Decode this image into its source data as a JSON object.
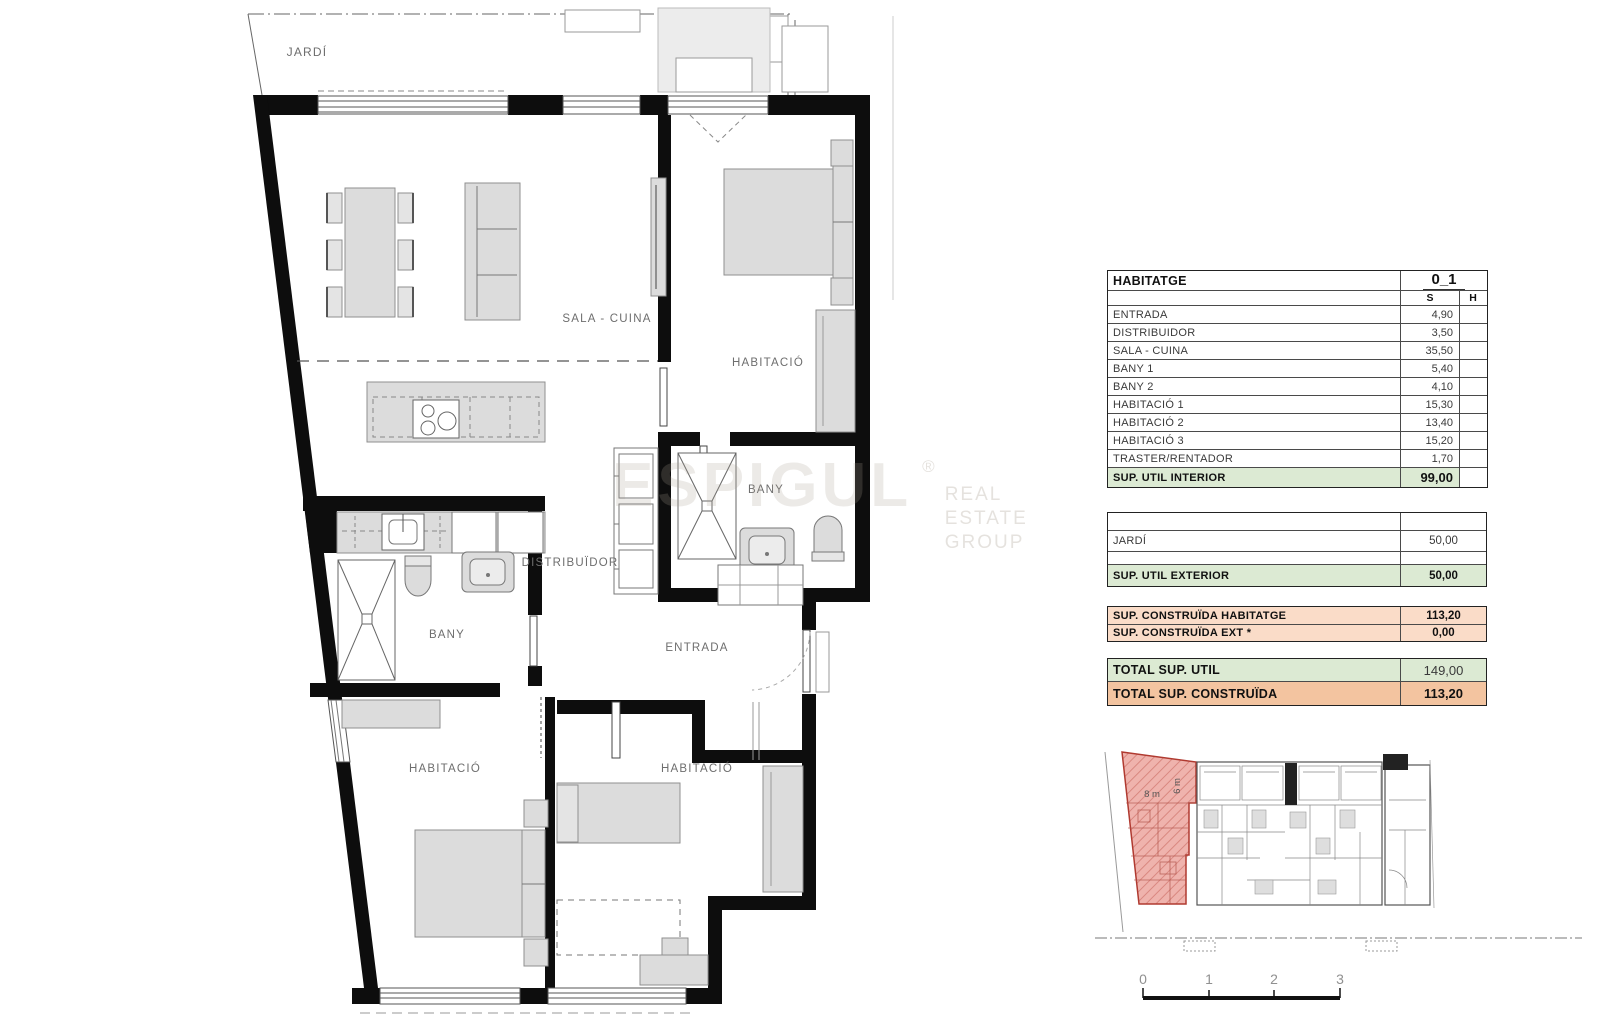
{
  "labels": {
    "jardi": "JARDÍ",
    "sala_cuina": "SALA - CUINA",
    "habitacio": "HABITACIÓ",
    "bany": "BANY",
    "distribuidor": "DISTRIBUÏDOR",
    "entrada": "ENTRADA"
  },
  "watermark": {
    "brand": "ESPIGUL",
    "reg": "®",
    "line1": "REAL ESTATE",
    "line2": "GROUP"
  },
  "table": {
    "title": "HABITATGE",
    "unit": "0_1",
    "col_s": "S",
    "col_h": "H",
    "rows": [
      {
        "label": "ENTRADA",
        "s": "4,90"
      },
      {
        "label": "DISTRIBUIDOR",
        "s": "3,50"
      },
      {
        "label": "SALA - CUINA",
        "s": "35,50"
      },
      {
        "label": "BANY 1",
        "s": "5,40"
      },
      {
        "label": "BANY 2",
        "s": "4,10"
      },
      {
        "label": "HABITACIÓ 1",
        "s": "15,30"
      },
      {
        "label": "HABITACIÓ 2",
        "s": "13,40"
      },
      {
        "label": "HABITACIÓ 3",
        "s": "15,20"
      },
      {
        "label": "TRASTER/RENTADOR",
        "s": "1,70"
      }
    ],
    "interior_total": {
      "label": "SUP. UTIL INTERIOR",
      "s": "99,00"
    },
    "exterior_rows": [
      {
        "label": "JARDÍ",
        "s": "50,00"
      }
    ],
    "exterior_total": {
      "label": "SUP. UTIL EXTERIOR",
      "s": "50,00"
    },
    "construida": [
      {
        "label": "SUP. CONSTRUÏDA  HABITATGE",
        "s": "113,20"
      },
      {
        "label": "SUP. CONSTRUÏDA EXT  *",
        "s": "0,00"
      }
    ],
    "totals": [
      {
        "label": "TOTAL SUP. UTIL",
        "s": "149,00"
      },
      {
        "label": "TOTAL SUP. CONSTRUÏDA",
        "s": "113,20"
      }
    ]
  },
  "site": {
    "dim_w": "8 m",
    "dim_h": "6 m",
    "scale": [
      "0",
      "1",
      "2",
      "3"
    ],
    "highlight_color": "#c0564d"
  }
}
